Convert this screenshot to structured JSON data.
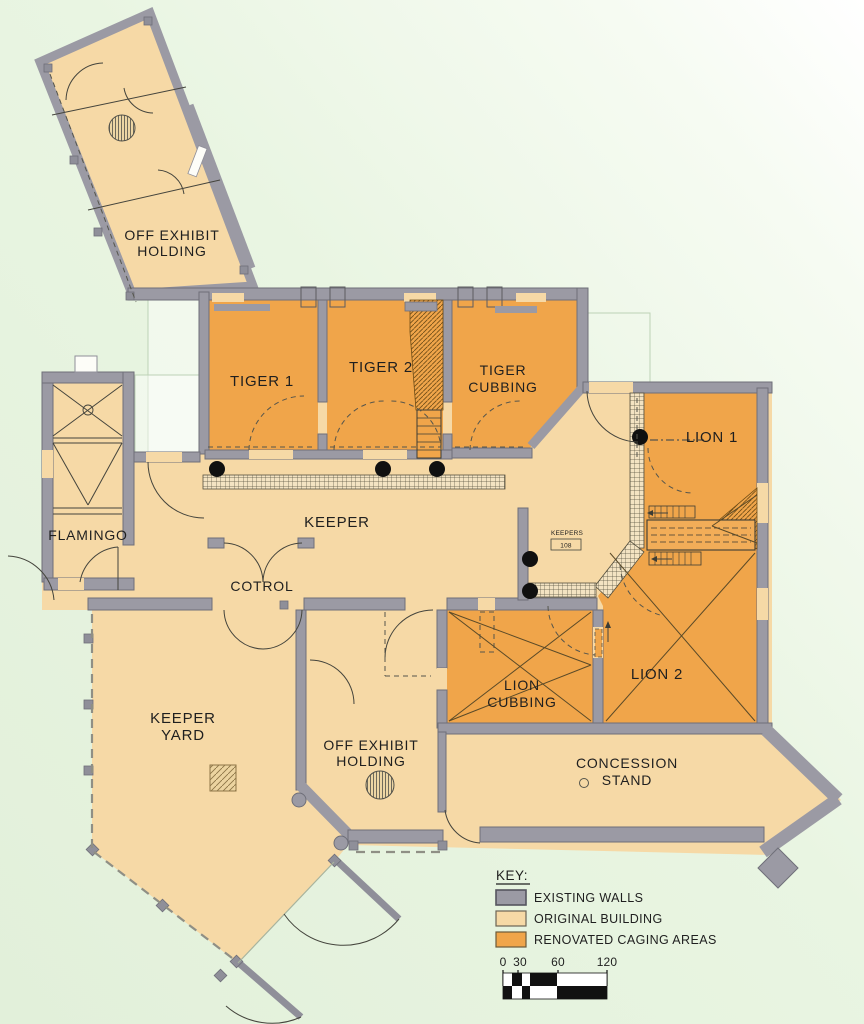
{
  "plan": {
    "title": "Feline House Renovation Floor Plan",
    "rooms": {
      "off_exhibit_top": {
        "line1": "OFF EXHIBIT",
        "line2": "HOLDING"
      },
      "tiger1": {
        "label": "TIGER 1"
      },
      "tiger2": {
        "label": "TIGER 2"
      },
      "tiger_cubbing": {
        "line1": "TIGER",
        "line2": "CUBBING"
      },
      "lion1": {
        "label": "LION 1"
      },
      "lion2": {
        "label": "LION 2"
      },
      "lion_cubbing": {
        "line1": "LION",
        "line2": "CUBBING"
      },
      "flamingo": {
        "label": "FLAMINGO"
      },
      "keeper": {
        "label": "KEEPER"
      },
      "control": {
        "label": "COTROL"
      },
      "keepers_office": {
        "label": "KEEPERS",
        "room_number": "108"
      },
      "keeper_yard": {
        "line1": "KEEPER",
        "line2": "YARD"
      },
      "off_exhibit_bottom": {
        "line1": "OFF EXHIBIT",
        "line2": "HOLDING"
      },
      "concession": {
        "line1": "CONCESSION",
        "line2": "STAND"
      }
    },
    "legend": {
      "title": "KEY:",
      "items": [
        {
          "label": "EXISTING WALLS",
          "color": "#9b9aa4"
        },
        {
          "label": "ORIGINAL BUILDING",
          "color": "#f6d9a6"
        },
        {
          "label": "RENOVATED CAGING AREAS",
          "color": "#f0a54a"
        }
      ]
    },
    "scale_bar": {
      "ticks": [
        "0",
        "30",
        "60",
        "120"
      ]
    }
  },
  "colors": {
    "existing_walls": "#9b9aa4",
    "original_building": "#f6d9a6",
    "renovated_caging": "#f0a54a",
    "background": "#e7f3e0"
  }
}
